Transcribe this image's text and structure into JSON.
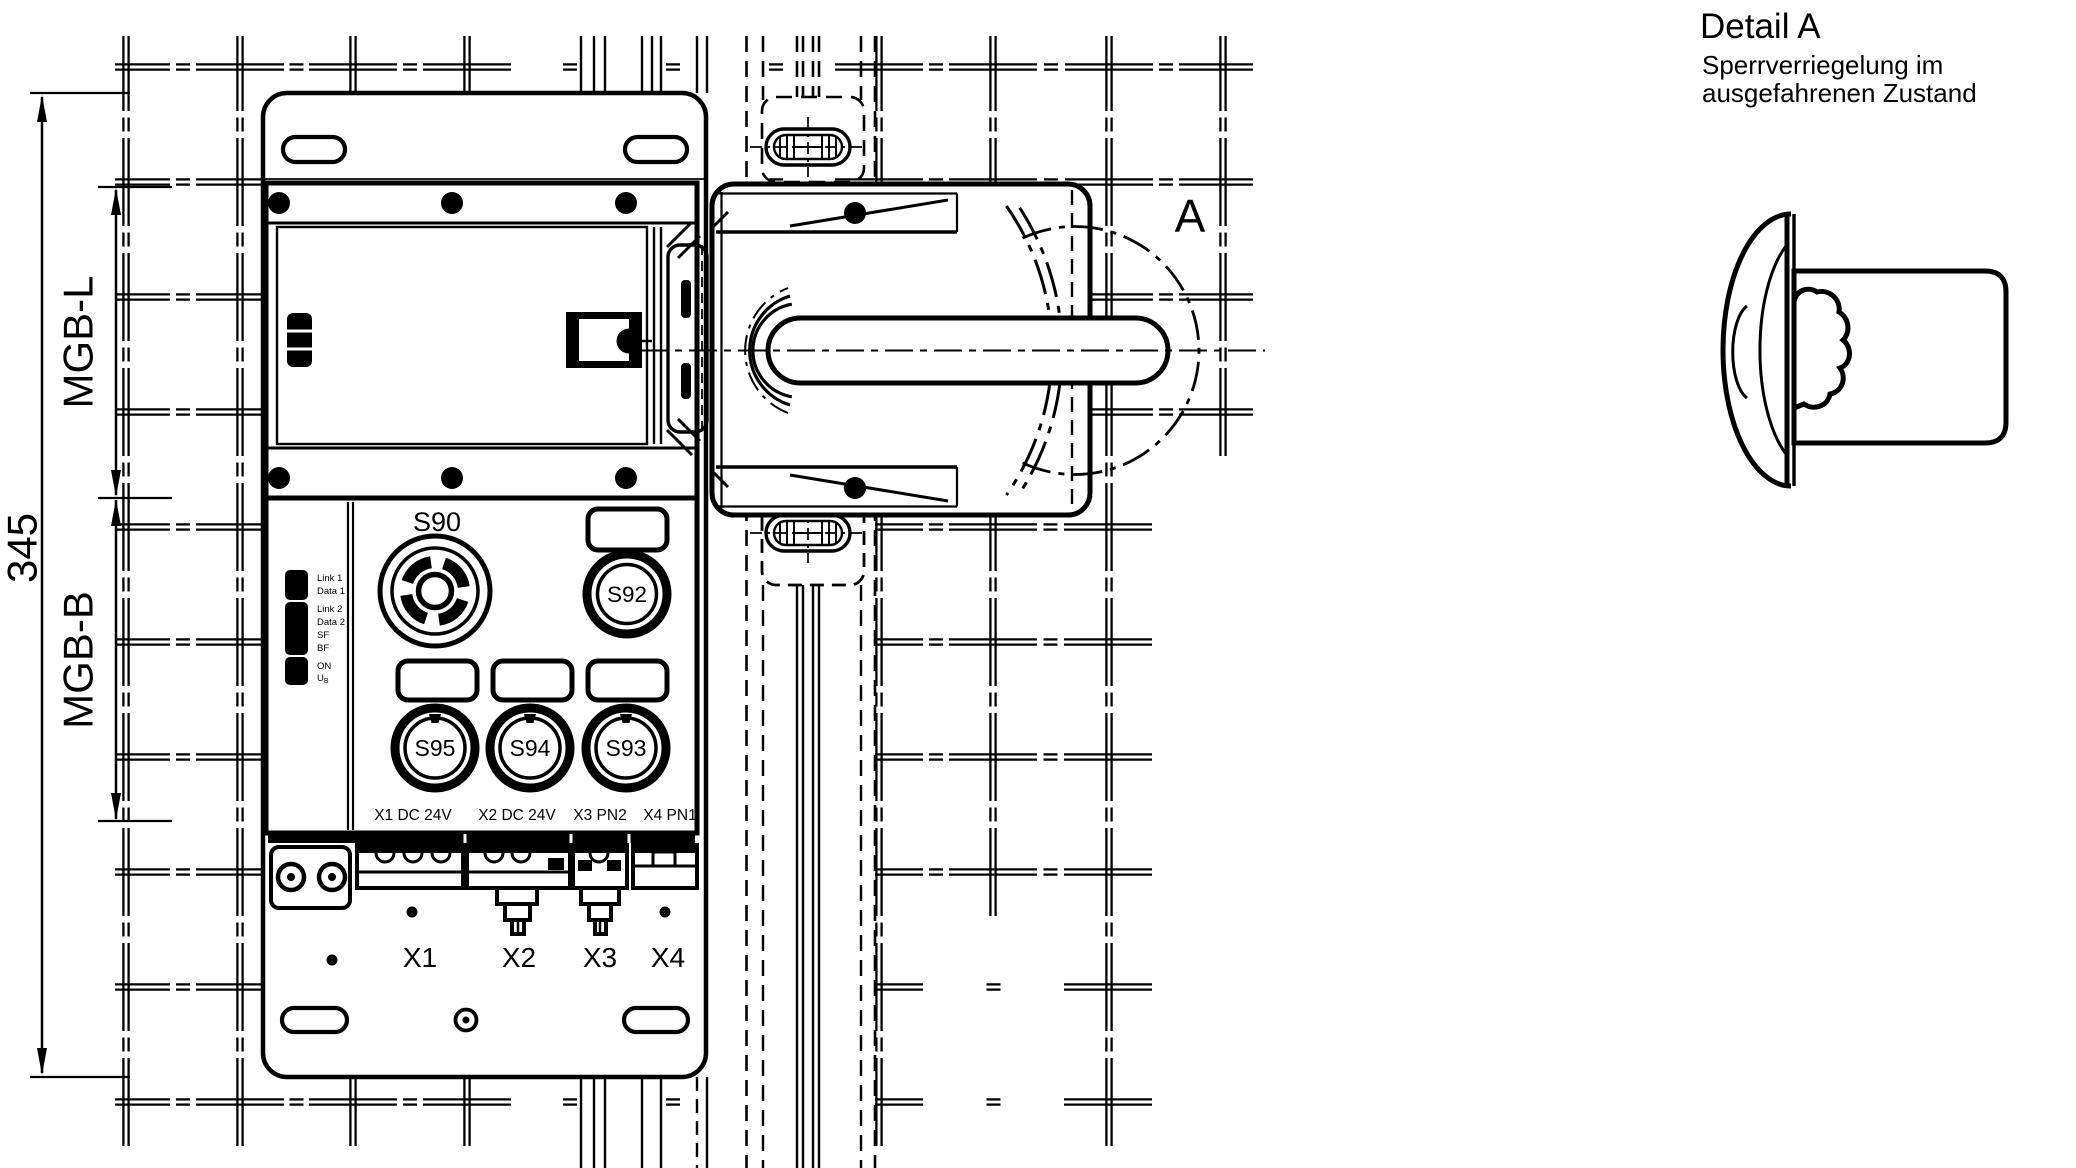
{
  "drawing": {
    "colors": {
      "ink": "#000000",
      "paper": "#ffffff"
    },
    "dimensions": {
      "overall_height": "345",
      "upper_module": "MGB-L",
      "lower_module": "MGB-B"
    },
    "device": {
      "estop_label": "S90",
      "button_s92": "S92",
      "button_s95": "S95",
      "button_s94": "S94",
      "button_s93": "S93",
      "led_labels": [
        "Link 1",
        "Data 1",
        "Link 2",
        "Data 2",
        "SF",
        "BF",
        "ON"
      ],
      "led_ub": {
        "main": "U",
        "sub": "B"
      },
      "port_labels": [
        "X1 DC 24V",
        "X2 DC 24V",
        "X3 PN2",
        "X4 PN1"
      ],
      "connector_labels": [
        "X1",
        "X2",
        "X3",
        "X4"
      ]
    },
    "detail_callout": {
      "marker": "A"
    },
    "detail_view": {
      "title": "Detail A",
      "caption_line1": "Sperrverriegelung im",
      "caption_line2": "ausgefahrenen Zustand"
    }
  }
}
